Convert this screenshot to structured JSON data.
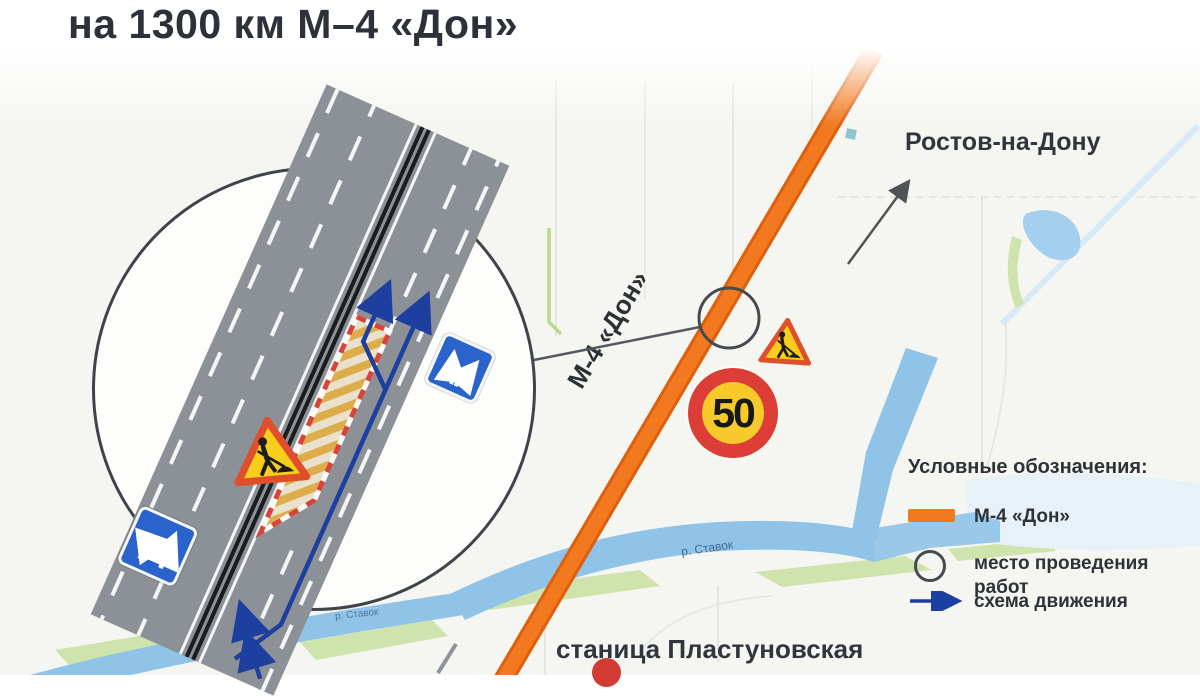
{
  "title": "на 1300 км М–4 «Дон»",
  "map": {
    "highway_label": "М-4 «Дон»",
    "city_label": "Ростов-на-Дону",
    "station_label": "станица Пластуновская",
    "river_label": "р. Ставок",
    "river_label_small": "р. Ставок",
    "speed_limit_sign": "50"
  },
  "legend": {
    "heading": "Условные обозначения:",
    "items": [
      {
        "label": "М-4 «Дон»",
        "swatch": "m4-road-line-swatch",
        "color": "#f2791f"
      },
      {
        "label": "место проведения работ",
        "swatch": "work-site-circle-swatch",
        "color": "#464b50"
      },
      {
        "label": "схема движения",
        "swatch": "traffic-scheme-arrow-swatch",
        "color": "#1d3f9f"
      }
    ]
  },
  "colors": {
    "highway_orange": "#f2791f",
    "scheme_blue": "#1d3f9f",
    "sign_blue": "#2a63cb",
    "warning_yellow": "#f8ce1d",
    "warning_red": "#df4f2b",
    "speed_ring_red": "#dc3d36",
    "road_gray": "#8b9196",
    "river_blue": "#8fc3e8",
    "text_dark": "#2e3338"
  }
}
